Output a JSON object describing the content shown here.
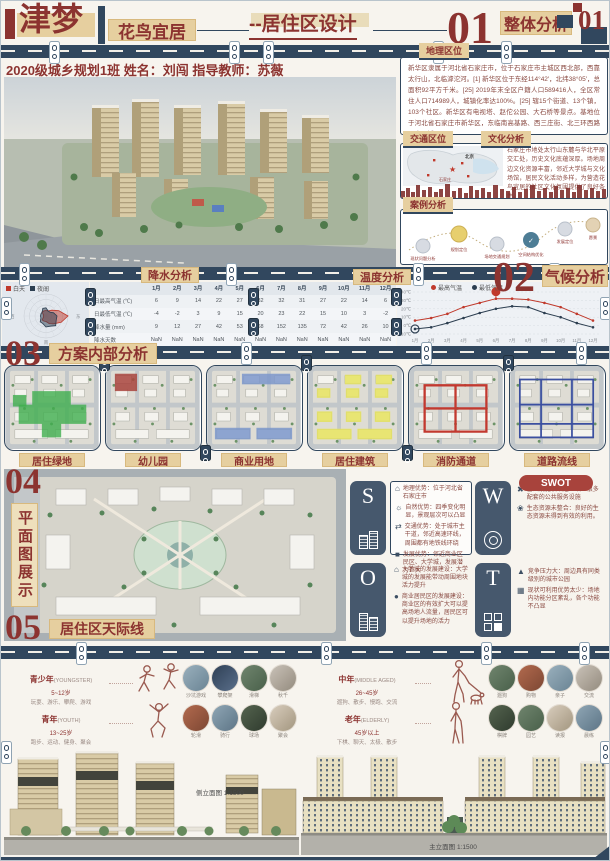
{
  "colors": {
    "navy": "#31475e",
    "dark_red": "#8c3330",
    "tan": "#e6cf9f"
  },
  "header": {
    "brand": "津梦",
    "tagline": "花鸟宜居",
    "subtitle": "--居住区设计",
    "section_num": "01",
    "section_label": "整体分析",
    "corner_num": "01",
    "credit": "2020级城乡规划1班 姓名：刘闯 指导教师：苏薇"
  },
  "right_col": {
    "geo_tag": "地理区位",
    "geo_text": "新华区隶属于河北省石家庄市，位于石家庄市主城区西北部，西靠太行山，北临滹沱河。[1] 新华区位于东经114°42′，北纬38°05′，总面积92平方千米。[25] 2019年末全区户籍人口589416人，全区常住人口714989人，城镇化率达100%。[25] 辖15个街道、13个镇，103个社区。新华区有电视塔、赵佗公园、大石桥等景点。基地位于河北省石家庄市新华区，东临南高基路、西三庄街、北三环西路围合区域。",
    "traffic_tag": "交通区位",
    "map_labels": [
      "北京",
      "石家庄"
    ],
    "culture_tag": "文化分析",
    "culture_text": "石家庄市地处太行山东麓与华北平原交汇处，历史文化底蕴深厚。场地周边文化资源丰富，邻近大学城与文化场馆，居民文化活动多样，为营造花鸟宜居的社区文化氛围提供了良好条件。",
    "case_tag": "案例分析",
    "case_steps": [
      {
        "label": "现状问题分析",
        "note": "场地问题梳理"
      },
      {
        "label": "规划定位",
        "note": "明确主题定位"
      },
      {
        "label": "场地交通规划",
        "note": "内外交通梳理"
      },
      {
        "label": "空间结构优化",
        "note": "轴线组团布局"
      },
      {
        "label": "发展定位",
        "note": "宜居活力社区"
      },
      {
        "label": "愿景",
        "note": "花鸟宜居"
      }
    ]
  },
  "climate": {
    "precip_tag": "降水分析",
    "temp_tag": "温度分析",
    "section_num": "02",
    "section_label": "气候分析"
  },
  "analysis03": {
    "num": "03",
    "label": "方案内部分析",
    "panels": [
      {
        "label": "居住绿地",
        "color": "#3fae4d",
        "type": "area"
      },
      {
        "label": "幼儿园",
        "color": "#a8433c",
        "type": "area"
      },
      {
        "label": "商业用地",
        "color": "#7c97cb",
        "type": "area"
      },
      {
        "label": "居住建筑",
        "color": "#e6e35e",
        "type": "area"
      },
      {
        "label": "消防通道",
        "color": "#c2392f",
        "type": "route"
      },
      {
        "label": "道路流线",
        "color": "#3b4fa0",
        "type": "route"
      }
    ]
  },
  "plan04": {
    "num": "04",
    "label": "平面图展示"
  },
  "swot": {
    "badge": "SWOT",
    "s": {
      "letter": "S",
      "points": [
        {
          "icon": "location-icon",
          "text": "地理优势：位于河北省石家庄市"
        },
        {
          "icon": "globe-icon",
          "text": "自然优势：四季变化明显，景观层次可以凸显"
        },
        {
          "icon": "road-icon",
          "text": "交通优势：处于城市主干道，邻近高速环线，周围都有地铁线环绕"
        },
        {
          "icon": "building-icon",
          "text": "发展优势：邻近商业区民区、大学城，发展潜力巨大"
        }
      ]
    },
    "w": {
      "letter": "W",
      "points": [
        {
          "icon": "tools-icon",
          "text": "基础设施较缺乏：缺少很多配套的公共服务设施"
        },
        {
          "icon": "eco-icon",
          "text": "生态资源未整合：良好的生态资源未得到有效的利用。"
        }
      ]
    },
    "o": {
      "letter": "O",
      "points": [
        {
          "icon": "school-icon",
          "text": "大学城的发展建设：大学城的发展能带动周围地块活力提升"
        },
        {
          "icon": "shop-icon",
          "text": "商业居民区的发展建设：商业区的有效扩大可以提高场地人流量，居民区可以提升场地的活力"
        }
      ]
    },
    "t": {
      "letter": "T",
      "points": [
        {
          "icon": "chart-icon",
          "text": "竞争压力大：周边具有同类级别的城市公园"
        },
        {
          "icon": "factory-icon",
          "text": "现状可利用优势太少：场地内功能分区紊乱，各个功能不凸显"
        }
      ]
    }
  },
  "skyline05": {
    "num": "05",
    "label": "居住区天际线"
  },
  "ages": [
    {
      "group": "青少年",
      "en": "(YOUNGSTER)",
      "age": "5~12岁",
      "acts": "玩耍、游乐、攀爬、游戏",
      "photos": [
        "沙坑游戏",
        "攀爬架",
        "滑梯",
        "秋千"
      ]
    },
    {
      "group": "青年",
      "en": "(YOUTH)",
      "age": "13~25岁",
      "acts": "跑步、运动、健身、聚会",
      "photos": [
        "轮滑",
        "骑行",
        "球场",
        "聚会"
      ]
    },
    {
      "group": "中年",
      "en": "(MIDDLE AGED)",
      "age": "26~45岁",
      "acts": "遛狗、散步、慢跑、交流",
      "photos": [
        "遛狗",
        "购物",
        "亲子",
        "交流"
      ]
    },
    {
      "group": "老年",
      "en": "(ELDERLY)",
      "age": "45岁以上",
      "acts": "下棋、聊天、太极、散步",
      "photos": [
        "棋牌",
        "园艺",
        "读报",
        "晨练"
      ]
    }
  ],
  "elevations": {
    "left_label": "侧立面图 1:1500",
    "right_label": "主立面图 1:1500"
  },
  "chart_data": [
    {
      "type": "radar",
      "name": "wind-rose",
      "max": 8,
      "axis_labels": [
        "北",
        "东",
        "南",
        "西"
      ],
      "series": [
        {
          "name": "白天",
          "color": "#c0392b",
          "values": [
            2,
            2,
            3,
            5,
            8,
            6,
            4,
            3,
            2,
            2,
            2,
            1,
            1,
            1,
            2,
            2
          ]
        },
        {
          "name": "夜间",
          "color": "#2c3e50",
          "values": [
            3,
            2,
            2,
            3,
            4,
            4,
            5,
            4,
            4,
            3,
            3,
            2,
            2,
            2,
            2,
            3
          ]
        }
      ]
    },
    {
      "type": "table",
      "name": "precip-table",
      "title": "降水分析",
      "columns": [
        "1月",
        "2月",
        "3月",
        "4月",
        "5月",
        "6月",
        "7月",
        "8月",
        "9月",
        "10月",
        "11月",
        "12月"
      ],
      "rows": [
        {
          "label": "日最高气温 (℃)",
          "values": [
            "6",
            "9",
            "14",
            "22",
            "27",
            "32",
            "32",
            "31",
            "27",
            "22",
            "14",
            "6"
          ]
        },
        {
          "label": "日最低气温 (℃)",
          "values": [
            "-4",
            "-2",
            "3",
            "9",
            "15",
            "20",
            "23",
            "22",
            "15",
            "10",
            "3",
            "-2"
          ]
        },
        {
          "label": "降水量 (mm)",
          "values": [
            "9",
            "12",
            "27",
            "42",
            "53",
            "68",
            "152",
            "135",
            "72",
            "42",
            "26",
            "10"
          ]
        },
        {
          "label": "降水天数",
          "values": [
            "NaN",
            "NaN",
            "NaN",
            "NaN",
            "NaN",
            "NaN",
            "NaN",
            "NaN",
            "NaN",
            "NaN",
            "NaN",
            "NaN"
          ]
        }
      ]
    },
    {
      "type": "line",
      "name": "temp-line",
      "title": "温度分析",
      "x": [
        "1月",
        "2月",
        "3月",
        "4月",
        "5月",
        "6月",
        "7月",
        "8月",
        "9月",
        "10月",
        "11月",
        "12月"
      ],
      "ylim": [
        -10,
        40
      ],
      "ylabel": "℃",
      "legend_position": "top",
      "grid": true,
      "series": [
        {
          "name": "最高气温",
          "color": "#c0392b",
          "values": [
            6,
            9,
            14,
            22,
            27,
            32,
            32,
            31,
            27,
            22,
            14,
            6
          ]
        },
        {
          "name": "最低气温",
          "color": "#2c3e50",
          "values": [
            -4,
            -2,
            3,
            9,
            15,
            20,
            23,
            22,
            15,
            10,
            3,
            -2
          ]
        }
      ],
      "annotations": [
        {
          "text": "20.33",
          "color": "#c0392b"
        },
        {
          "text": "9.42",
          "color": "#2c3e50"
        }
      ]
    }
  ]
}
